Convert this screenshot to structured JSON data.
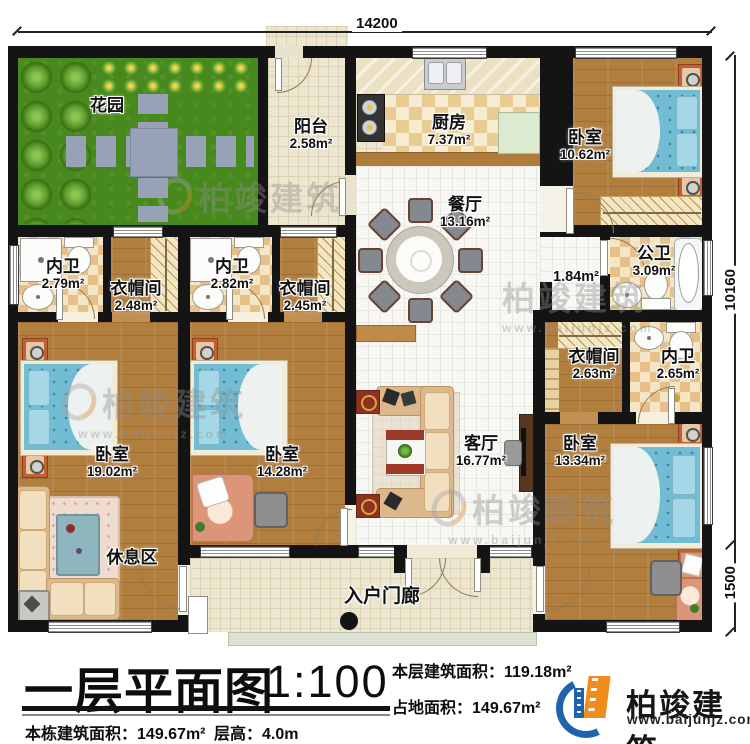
{
  "title_block": {
    "plan_title": "一层平面图",
    "scale": "1:100",
    "floor_area_label": "本层建筑面积：",
    "floor_area_value": "119.18m²",
    "land_area_label": "占地面积：",
    "land_area_value": "149.67m²",
    "building_area_label": "本栋建筑面积：",
    "building_area_value": "149.67m²",
    "height_label": "层高：",
    "height_value": "4.0m"
  },
  "logo": {
    "name": "柏竣建筑",
    "url": "www.baijunjz.com"
  },
  "watermark": {
    "text": "柏竣建筑",
    "url": "www.baijunjz.com"
  },
  "dimensions": {
    "top_width": "14200",
    "right_height": "10160",
    "right_porch": "1500"
  },
  "rooms": [
    {
      "id": "garden",
      "name": "花园",
      "area": ""
    },
    {
      "id": "balcony",
      "name": "阳台",
      "area": "2.58m²"
    },
    {
      "id": "kitchen",
      "name": "厨房",
      "area": "7.37m²"
    },
    {
      "id": "bedroom-top-right",
      "name": "卧室",
      "area": "10.62m²"
    },
    {
      "id": "dining",
      "name": "餐厅",
      "area": "13.16m²"
    },
    {
      "id": "bath-1",
      "name": "内卫",
      "area": "2.79m²"
    },
    {
      "id": "cloak-1",
      "name": "衣帽间",
      "area": "2.48m²"
    },
    {
      "id": "bath-2",
      "name": "内卫",
      "area": "2.82m²"
    },
    {
      "id": "cloak-2",
      "name": "衣帽间",
      "area": "2.45m²"
    },
    {
      "id": "hall",
      "name": "",
      "area": "1.84m²"
    },
    {
      "id": "public-bath",
      "name": "公卫",
      "area": "3.09m²"
    },
    {
      "id": "cloak-3",
      "name": "衣帽间",
      "area": "2.63m²"
    },
    {
      "id": "bath-3",
      "name": "内卫",
      "area": "2.65m²"
    },
    {
      "id": "bedroom-left",
      "name": "卧室",
      "area": "19.02m²"
    },
    {
      "id": "bedroom-mid",
      "name": "卧室",
      "area": "14.28m²"
    },
    {
      "id": "living",
      "name": "客厅",
      "area": "16.77m²"
    },
    {
      "id": "bedroom-bottom-right",
      "name": "卧室",
      "area": "13.34m²"
    },
    {
      "id": "rest-area",
      "name": "休息区",
      "area": ""
    },
    {
      "id": "porch",
      "name": "入户门廊",
      "area": ""
    }
  ]
}
